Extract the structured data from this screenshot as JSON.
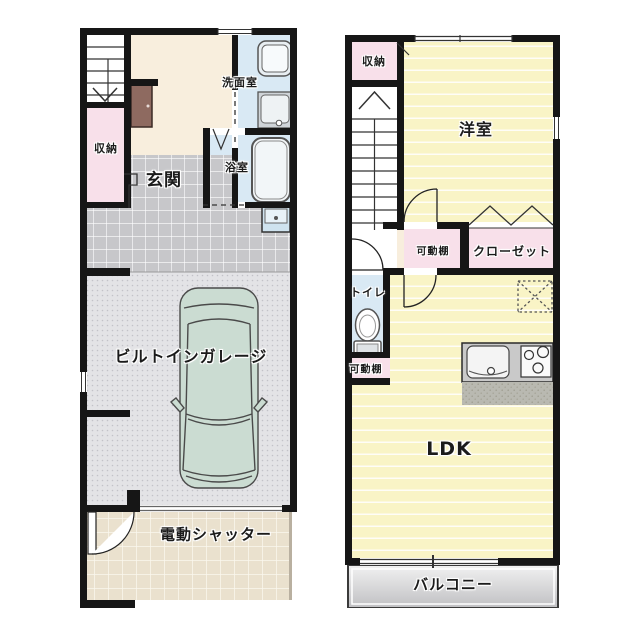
{
  "title": "2-story house floor plan",
  "floor1": {
    "storage": "収納",
    "entrance": "玄関",
    "washroom": "洗面室",
    "bathroom": "浴室",
    "garage": "ビルトインガレージ",
    "shutter": "電動シャッター"
  },
  "floor2": {
    "storage": "収納",
    "western_room": "洋室",
    "shelf_upper": "可動棚",
    "closet": "クローゼット",
    "toilet": "トイレ",
    "shelf_lower": "可動棚",
    "ldk": "LDK",
    "balcony": "バルコニー"
  },
  "colors": {
    "wall": "#161616",
    "room_pink": "#f8e0ea",
    "room_blue": "#d9e9f4",
    "hall_cream": "#f8eedd",
    "floor_yellow": "#f9f4c6",
    "tile_gray": "#c7c7ca",
    "garage_gray": "#e3e3e6",
    "driveway_beige": "#eae1ce",
    "balcony_gray": "#cfcfd2",
    "car_body": "#cbdcd2",
    "shoe_cabinet_brown": "#8e6a60",
    "kitchen_counter": "#c9c9c9"
  },
  "fixtures": [
    "staircase-down",
    "staircase-up",
    "shoe-cabinet",
    "washing-machine",
    "vanity-sink",
    "bathtub",
    "folding-bath-door",
    "slop-sink",
    "car",
    "entrance-door",
    "electric-shutter-line",
    "toilet",
    "kitchen-sink",
    "gas-stove",
    "refrigerator-space",
    "folding-closet-door",
    "sliding-window"
  ]
}
